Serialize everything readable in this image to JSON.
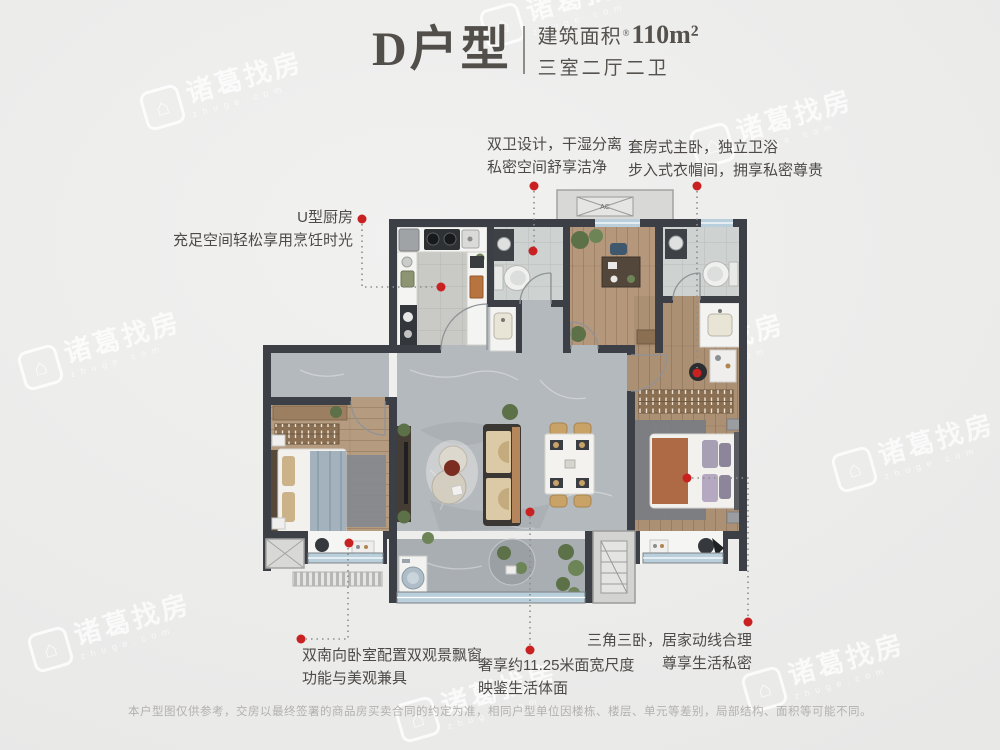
{
  "header": {
    "plan_name": "D户型",
    "area_prefix": "建筑面积",
    "area_reg": "®",
    "area_value": "110m²",
    "rooms_text": "三室二厅二卫"
  },
  "annotations": {
    "kitchen": {
      "line1": "U型厨房",
      "line2": "充足空间轻松享用烹饪时光"
    },
    "bathrooms": {
      "line1": "双卫设计，干湿分离",
      "line2": "私密空间舒享洁净"
    },
    "master_suite": {
      "line1": "套房式主卧，独立卫浴",
      "line2": "步入式衣帽间，拥享私密尊贵"
    },
    "south_bedrooms": {
      "line1": "双南向卧室配置双观景飘窗",
      "line2": "功能与美观兼具"
    },
    "bay_width": {
      "line1": "奢享约11.25米面宽尺度",
      "line2": "映鉴生活体面"
    },
    "bedroom_layout": {
      "line1": "三角三卧，居家动线合理",
      "line2": "尊享生活私密"
    }
  },
  "plan": {
    "ac_label": "AC"
  },
  "watermark": {
    "brand": "诸葛找房",
    "domain": "zhuge.com",
    "logo_glyph": "⌂"
  },
  "disclaimer": "本户型图仅供参考，交房以最终签署的商品房买卖合同的约定为准，相同户型单位因楼栋、楼层、单元等差别，局部结构、面积等可能不同。",
  "colors": {
    "accent_red": "#c92121",
    "wall": "#3c4046",
    "window_blue": "#b9cfdc"
  }
}
